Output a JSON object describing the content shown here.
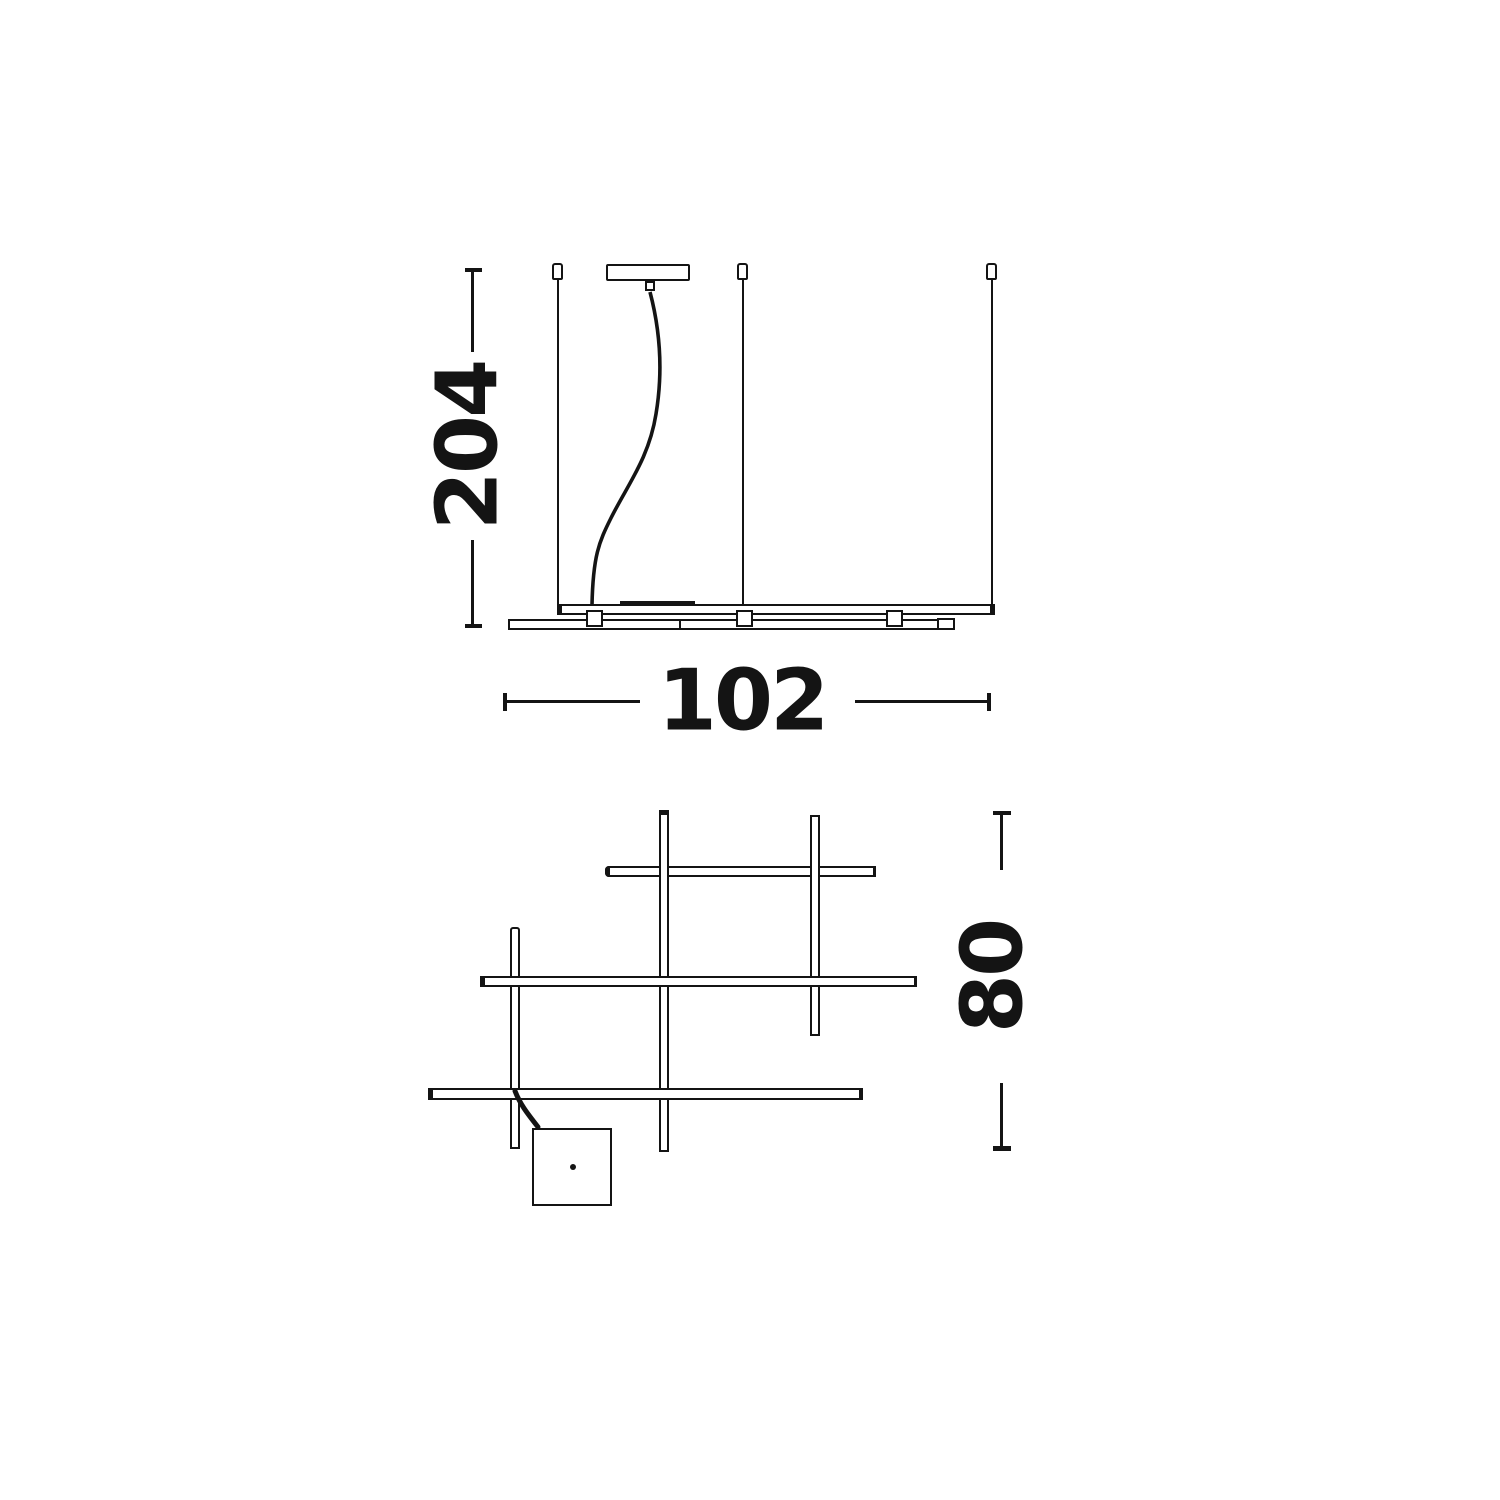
{
  "page": {
    "background_color": "#ffffff",
    "line_color": "#141414"
  },
  "side_view": {
    "height_dimension": "204",
    "width_dimension": "102"
  },
  "top_view": {
    "depth_dimension": "80"
  }
}
